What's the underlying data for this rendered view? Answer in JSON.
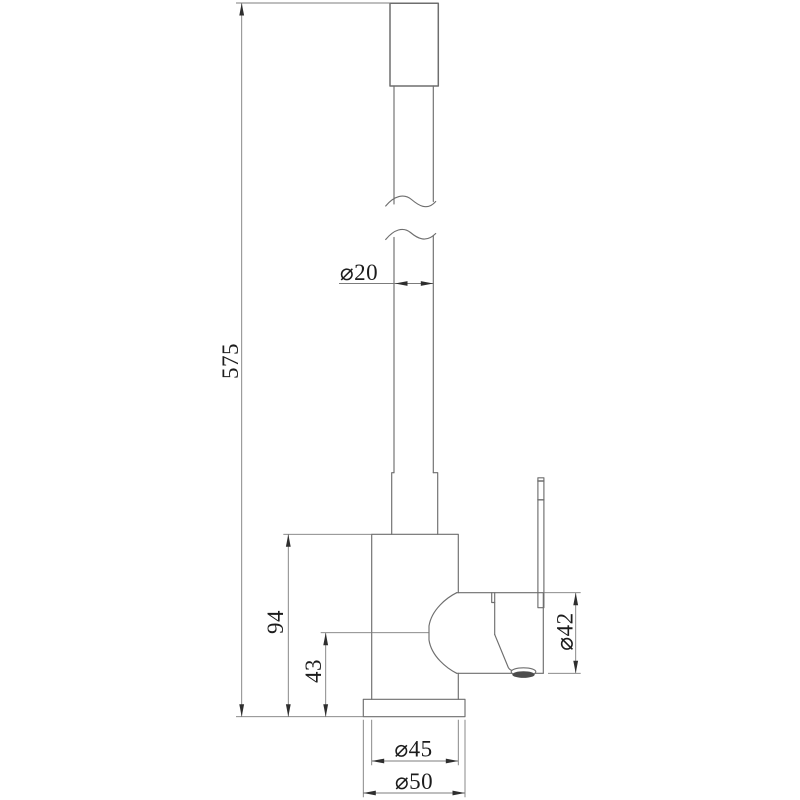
{
  "drawing": {
    "type": "technical-dimension-drawing",
    "subject": "kitchen-faucet-side-view",
    "colors": {
      "background": "#ffffff",
      "part_line": "#6e6e6e",
      "dim_line": "#7c7c7c",
      "arrow": "#2e2e2e",
      "text": "#1c1c1c",
      "aerator_fill": "#4c4c4c"
    },
    "dimensions": {
      "total_height": "575",
      "tube_diameter": "⌀20",
      "body_height": "94",
      "spout_pivot_height": "43",
      "head_diameter": "⌀42",
      "body_diameter": "⌀45",
      "base_diameter": "⌀50"
    }
  }
}
